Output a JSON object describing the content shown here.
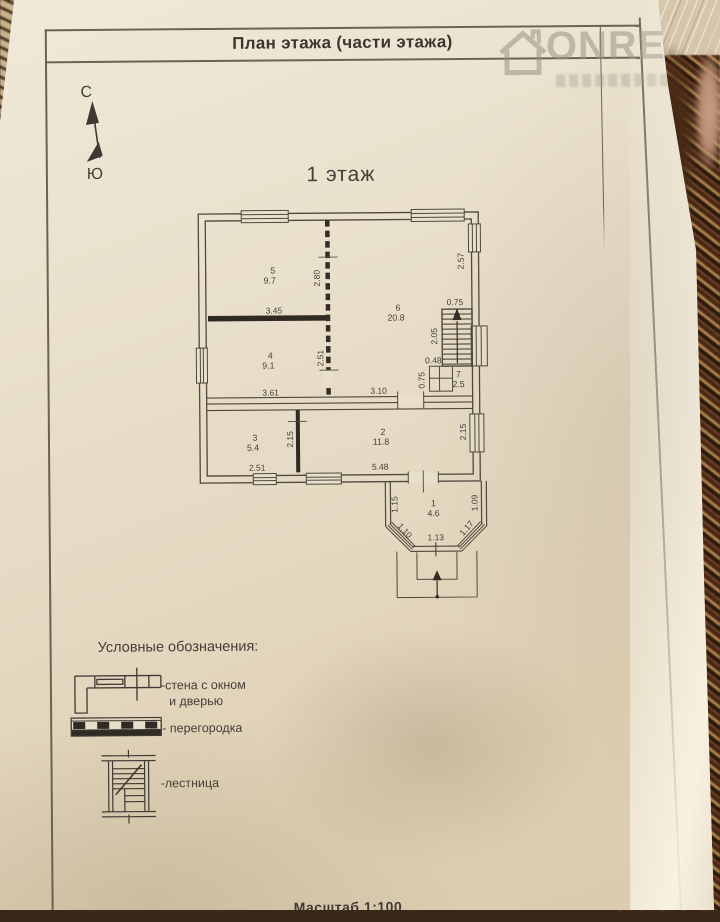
{
  "header": {
    "title": "План этажа (части этажа)"
  },
  "watermark": {
    "brand": "ONREA"
  },
  "compass": {
    "north": "С",
    "south": "Ю"
  },
  "floor": {
    "title": "1 этаж"
  },
  "plan": {
    "rooms": {
      "r1": {
        "num": "1",
        "area": "4.6"
      },
      "r2": {
        "num": "2",
        "area": "11.8"
      },
      "r3": {
        "num": "3",
        "area": "5.4"
      },
      "r4": {
        "num": "4",
        "area": "9.1"
      },
      "r5": {
        "num": "5",
        "area": "9.7"
      },
      "r6": {
        "num": "6",
        "area": "20.8"
      },
      "r7": {
        "num": "7",
        "area": "2.5"
      }
    },
    "dims": {
      "w280": "2.80",
      "w345": "3.45",
      "w257": "2.57",
      "w075_stairs": "0.75",
      "w205": "2.05",
      "w048": "0.48",
      "w075_wc": "0.75",
      "w251_4": "2.51",
      "w361": "3.61",
      "w310": "3.10",
      "w215_3": "2.15",
      "w251_3": "2.51",
      "w548": "5.48",
      "w215_2": "2.15",
      "w115": "1.15",
      "w109": "1.09",
      "w110": "1.10",
      "w117": "1.17",
      "w113": "1.13"
    }
  },
  "legend": {
    "title": "Условные обозначения:",
    "wall_label_1": "-стена с окном",
    "wall_label_2": "и дверью",
    "partition_label": "- перегородка",
    "stairs_label": "-лестница"
  },
  "footer": {
    "scale": "Масштаб 1:100"
  }
}
